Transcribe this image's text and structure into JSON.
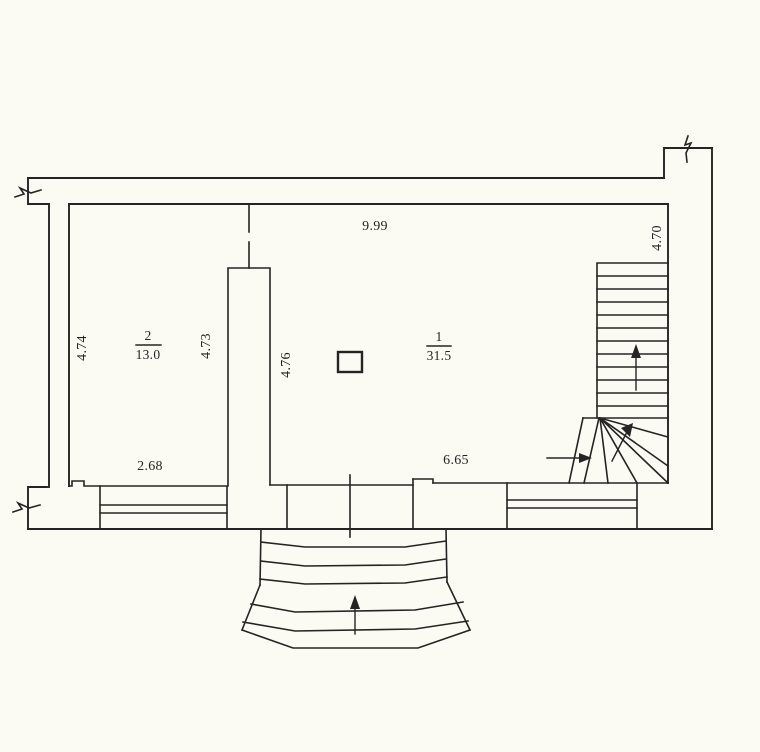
{
  "document": {
    "type": "scanned-floor-plan",
    "colors": {
      "paper": "#fbfaf3",
      "ink": "#242424"
    }
  },
  "plan": {
    "dims": {
      "top_width": "9.99",
      "stair_side": "4.70",
      "left_height": "4.74",
      "room2_right": "4.73",
      "room1_left": "4.76",
      "bottom_left_width": "2.68",
      "bottom_right_width": "6.65"
    },
    "rooms": {
      "room1": {
        "number": "1",
        "area": "31.5"
      },
      "room2": {
        "number": "2",
        "area": "13.0"
      }
    }
  }
}
